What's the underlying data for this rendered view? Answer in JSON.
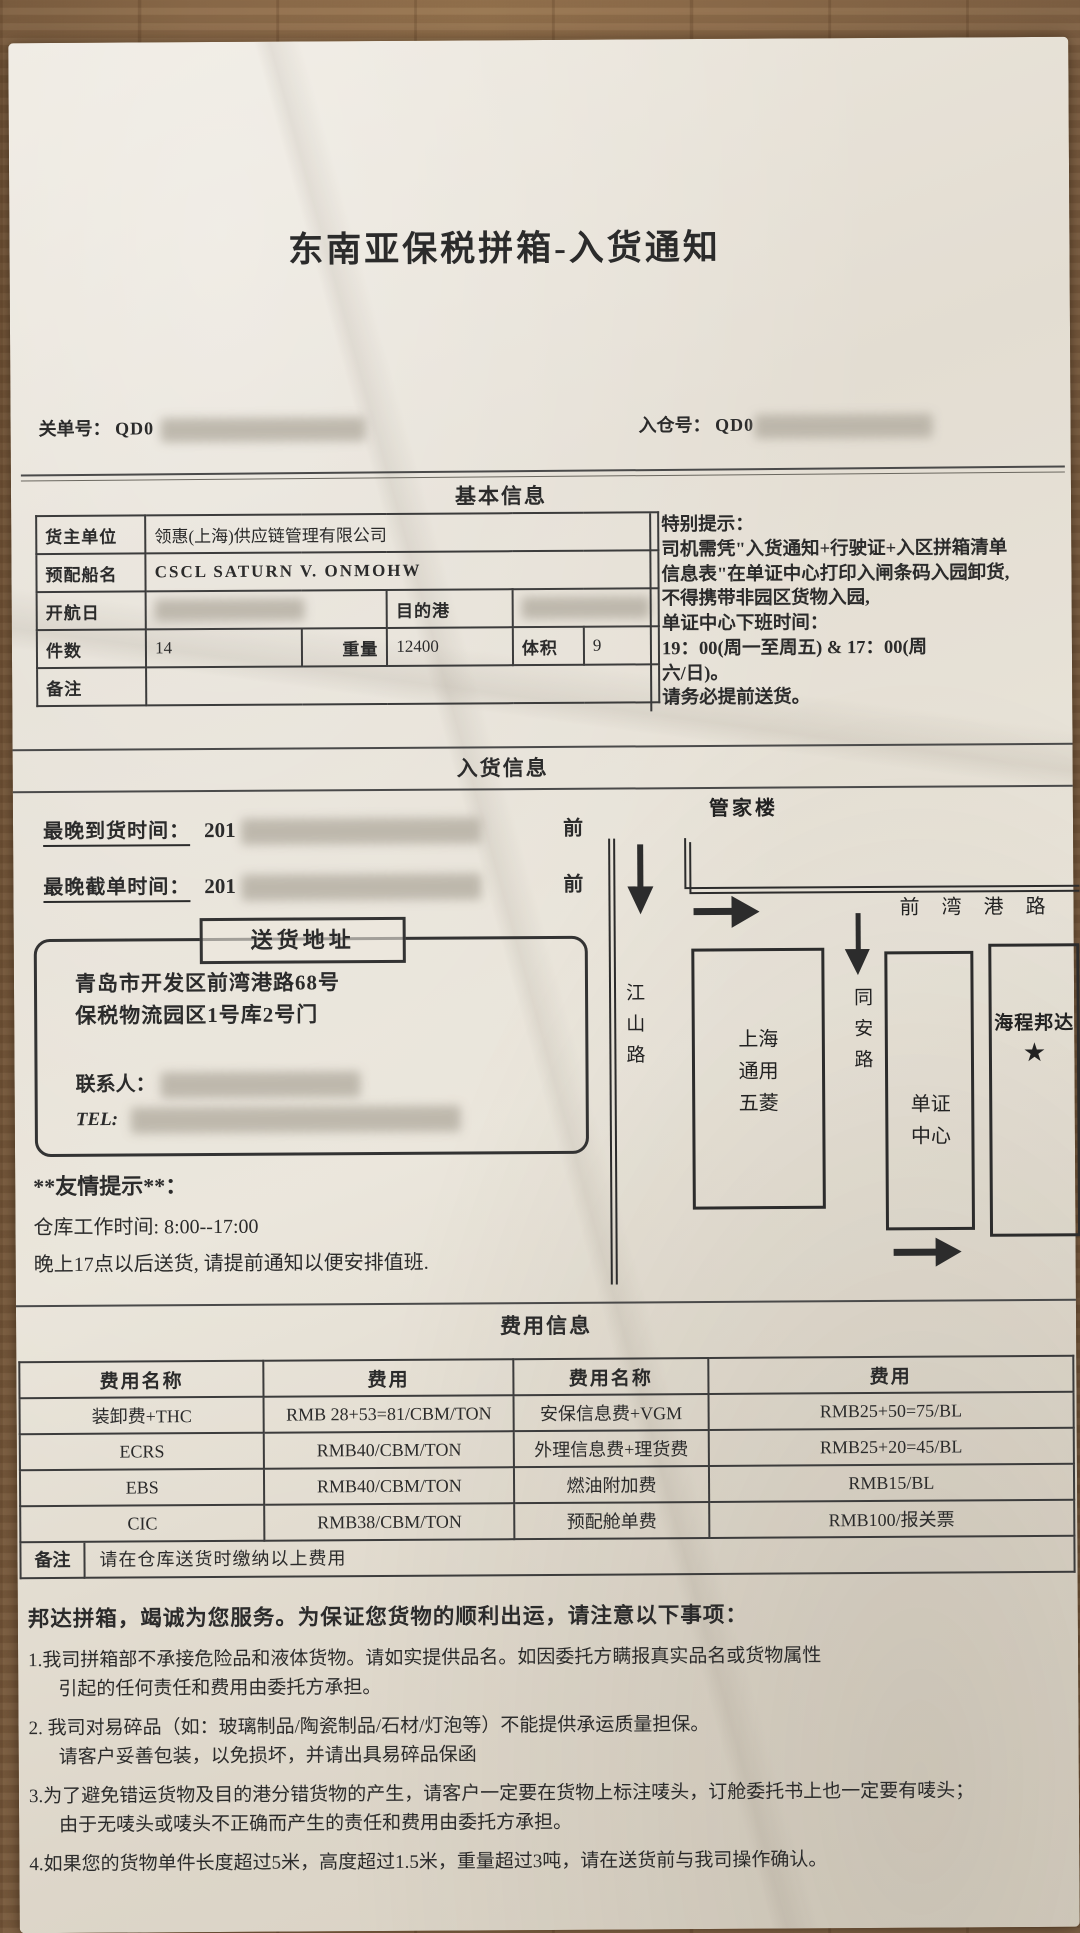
{
  "title": "东南亚保税拼箱-入货通知",
  "refs": {
    "customs_label": "关单号：",
    "customs_value": "QD0",
    "warehouse_label": "入仓号：",
    "warehouse_value": "QD0"
  },
  "sections": {
    "basic": "基本信息",
    "inbound": "入货信息",
    "fees": "费用信息"
  },
  "basic_info": {
    "owner_label": "货主单位",
    "owner_value": "领惠(上海)供应链管理有限公司",
    "vessel_label": "预配船名",
    "vessel_value": "CSCL SATURN V. ONMOHW",
    "sail_label": "开航日",
    "dest_label": "目的港",
    "pieces_label": "件数",
    "pieces_value": "14",
    "weight_label": "重量",
    "weight_value": "12400",
    "volume_label": "体积",
    "volume_value": "9",
    "remark_label": "备注",
    "remark_value": ""
  },
  "special_notice": "特别提示：\n司机需凭\"入货通知+行驶证+入区拼箱清单\n信息表\"在单证中心打印入闸条码入园卸货,\n不得携带非园区货物入园,\n单证中心下班时间：\n19：00(周一至周五) & 17：00(周\n六/日)。\n请务必提前送货。",
  "inbound_info": {
    "arrival_label": "最晚到货时间：",
    "arrival_value": "201",
    "arrival_suffix": "前",
    "cutoff_label": "最晚截单时间：",
    "cutoff_value": "201",
    "cutoff_suffix": "前",
    "address_box_label": "送货地址",
    "address_line1": "青岛市开发区前湾港路68号",
    "address_line2": "保税物流园区1号库2号门",
    "contact_label": "联系人：",
    "tel_label": "TEL:",
    "tips_title": "**友情提示**：",
    "tips_line1": "仓库工作时间: 8:00--17:00",
    "tips_line2": "晚上17点以后送货, 请提前通知以便安排值班."
  },
  "map": {
    "building_top": "管家楼",
    "road_left": "江山路",
    "road_top": "前湾港路",
    "road_mid": "同安路",
    "box_factory": "上海通用五菱",
    "box_docs_center": "单证中心",
    "box_destination": "海程邦达",
    "star": "★"
  },
  "fee_table": {
    "headers": [
      "费用名称",
      "费用",
      "费用名称",
      "费用"
    ],
    "rows": [
      [
        "装卸费+THC",
        "RMB 28+53=81/CBM/TON",
        "安保信息费+VGM",
        "RMB25+50=75/BL"
      ],
      [
        "ECRS",
        "RMB40/CBM/TON",
        "外理信息费+理货费",
        "RMB25+20=45/BL"
      ],
      [
        "EBS",
        "RMB40/CBM/TON",
        "燃油附加费",
        "RMB15/BL"
      ],
      [
        "CIC",
        "RMB38/CBM/TON",
        "预配舱单费",
        "RMB100/报关票"
      ]
    ],
    "remark_label": "备注",
    "remark_value": "请在仓库送货时缴纳以上费用"
  },
  "notes": {
    "intro": "邦达拼箱，竭诚为您服务。为保证您货物的顺利出运，请注意以下事项：",
    "items": [
      "1.我司拼箱部不承接危险品和液体货物。请如实提供品名。如因委托方瞒报真实品名或货物属性\n引起的任何责任和费用由委托方承担。",
      "2. 我司对易碎品（如：玻璃制品/陶瓷制品/石材/灯泡等）不能提供承运质量担保。\n请客户妥善包装，以免损坏，并请出具易碎品保函",
      "3.为了避免错运货物及目的港分错货物的产生，请客户一定要在货物上标注唛头，订舱委托书上也一定要有唛头；\n由于无唛头或唛头不正确而产生的责任和费用由委托方承担。",
      "4.如果您的货物单件长度超过5米，高度超过1.5米，重量超过3吨，请在送货前与我司操作确认。"
    ]
  }
}
